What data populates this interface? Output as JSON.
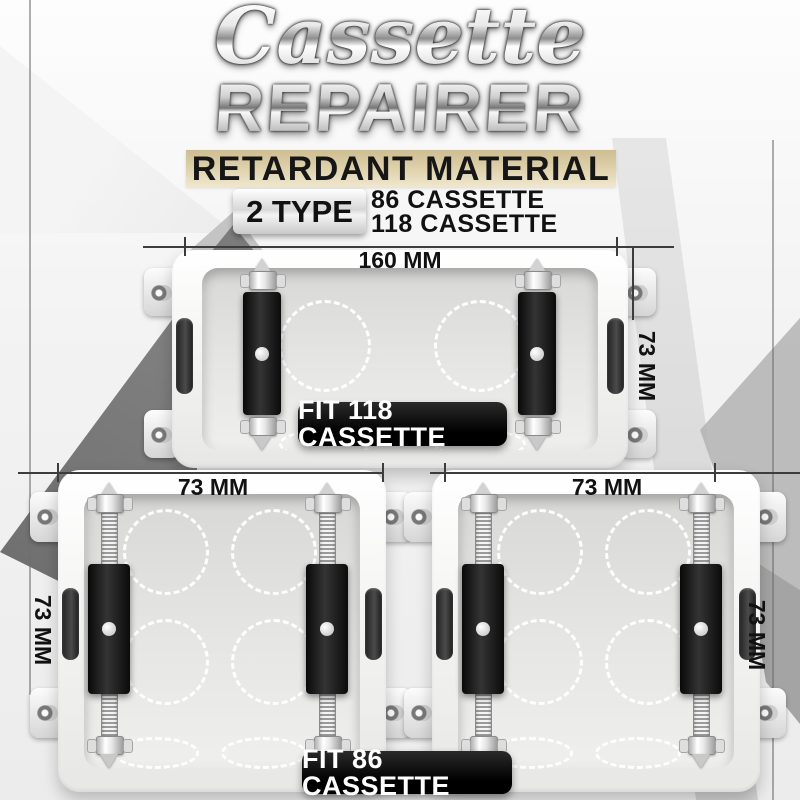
{
  "header": {
    "title_script": "Cassette",
    "title_main": "REPAIRER",
    "banner": "RETARDANT MATERIAL",
    "type_label": "2 TYPE",
    "type_options": [
      "86 CASSETTE",
      "118 CASSETTE"
    ]
  },
  "products": {
    "cassette_118": {
      "badge": "FIT 118 CASSETTE",
      "width_label": "160 MM",
      "height_label": "73 MM"
    },
    "cassette_86_left": {
      "width_label": "73 MM",
      "height_label": "73 MM"
    },
    "cassette_86_right": {
      "width_label": "73 MM",
      "height_label": "73 MM"
    },
    "badge_86": "FIT 86 CASSETTE"
  },
  "colors": {
    "banner_tan": "#d8c8a2",
    "badge_bg": "#0a0a0a",
    "badge_text": "#ffffff",
    "ink": "#141414",
    "bracket_black": "#111111",
    "dimension_line": "#3c3c3c"
  }
}
